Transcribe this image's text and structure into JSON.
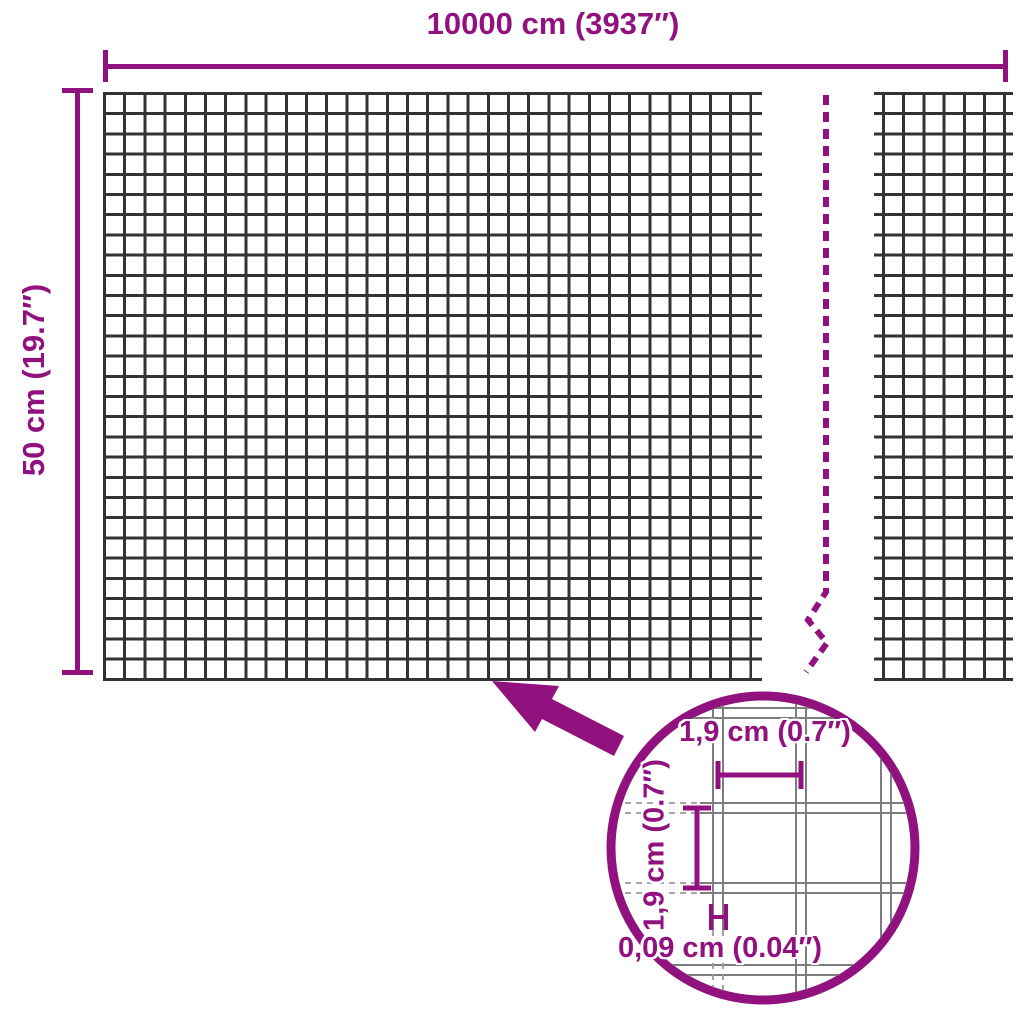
{
  "diagram": {
    "colors": {
      "accent": "#91127f",
      "mesh": "#333333",
      "wire": "#7d7d7d",
      "guide": "#999999"
    },
    "overall": {
      "width_label": "10000 cm (3937″)",
      "height_label": "50 cm (19.7″)"
    },
    "detail": {
      "mesh_width_label": "1,9 cm (0.7″)",
      "mesh_height_label": "1,9 cm (0.7″)",
      "wire_thickness_label": "0,09 cm (0.04″)"
    }
  }
}
